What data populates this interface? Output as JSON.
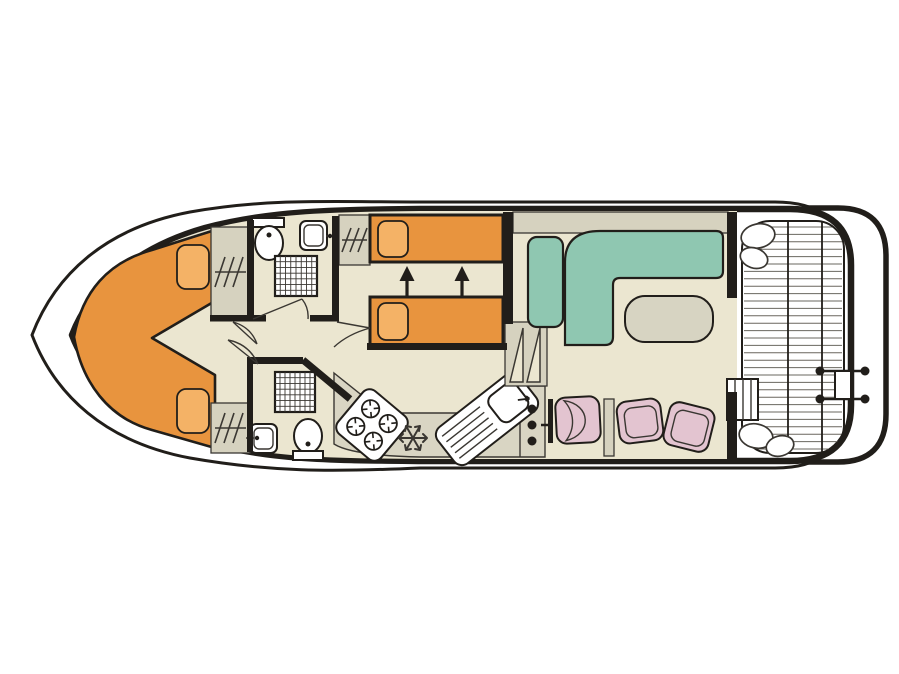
{
  "page": {
    "title": "Boat deck plan",
    "description": "Top-view floor plan of a canal cruiser: bow V-berth cabin, two bathrooms, twin-bed cabin, saloon with L-sofa and table, galley, helm seat and aft deck with swim platform"
  },
  "colors": {
    "dark": "#211e1a",
    "line": "#3a3732",
    "floor": "#ebe6d0",
    "gray": "#d6d2bf",
    "counter": "#d9d5c3",
    "bedOrange": "#e8943e",
    "pillow": "#f4b266",
    "teal": "#8fc7b1",
    "pink": "#e3c4d0",
    "tableGray": "#d7d4c2",
    "plank": "#6a675f"
  },
  "icons": {
    "toilet-icon": "oval bowl with cistern",
    "washbasin-icon": "rounded square with tap dot",
    "shower-icon": "square grid tray",
    "wardrobe-icon": "rail with hanger strokes",
    "stove-icon": "four burner rings",
    "fridge-icon": "snowflake",
    "sink-drainer-icon": "basin with drainer lines",
    "bed-slide-arrows-icon": "two up arrows",
    "swim-ladder-icon": "two rungs with end pins",
    "deck-steps-icon": "rectangle with rungs"
  },
  "rooms": [
    {
      "id": "bow-cabin",
      "feature": "v-berth double bed"
    },
    {
      "id": "bathroom-fore",
      "feature": "toilet, washbasin, shower"
    },
    {
      "id": "twin-cabin",
      "feature": "two sliding single beds"
    },
    {
      "id": "bathroom-aft",
      "feature": "toilet, washbasin, shower"
    },
    {
      "id": "galley",
      "feature": "stove, fridge, sink"
    },
    {
      "id": "saloon",
      "feature": "L-sofa, bench, table"
    },
    {
      "id": "helm",
      "feature": "helm seat, two stools"
    },
    {
      "id": "aft-deck",
      "feature": "planked deck, steps, seats"
    },
    {
      "id": "swim-platform",
      "feature": "ladder"
    }
  ]
}
